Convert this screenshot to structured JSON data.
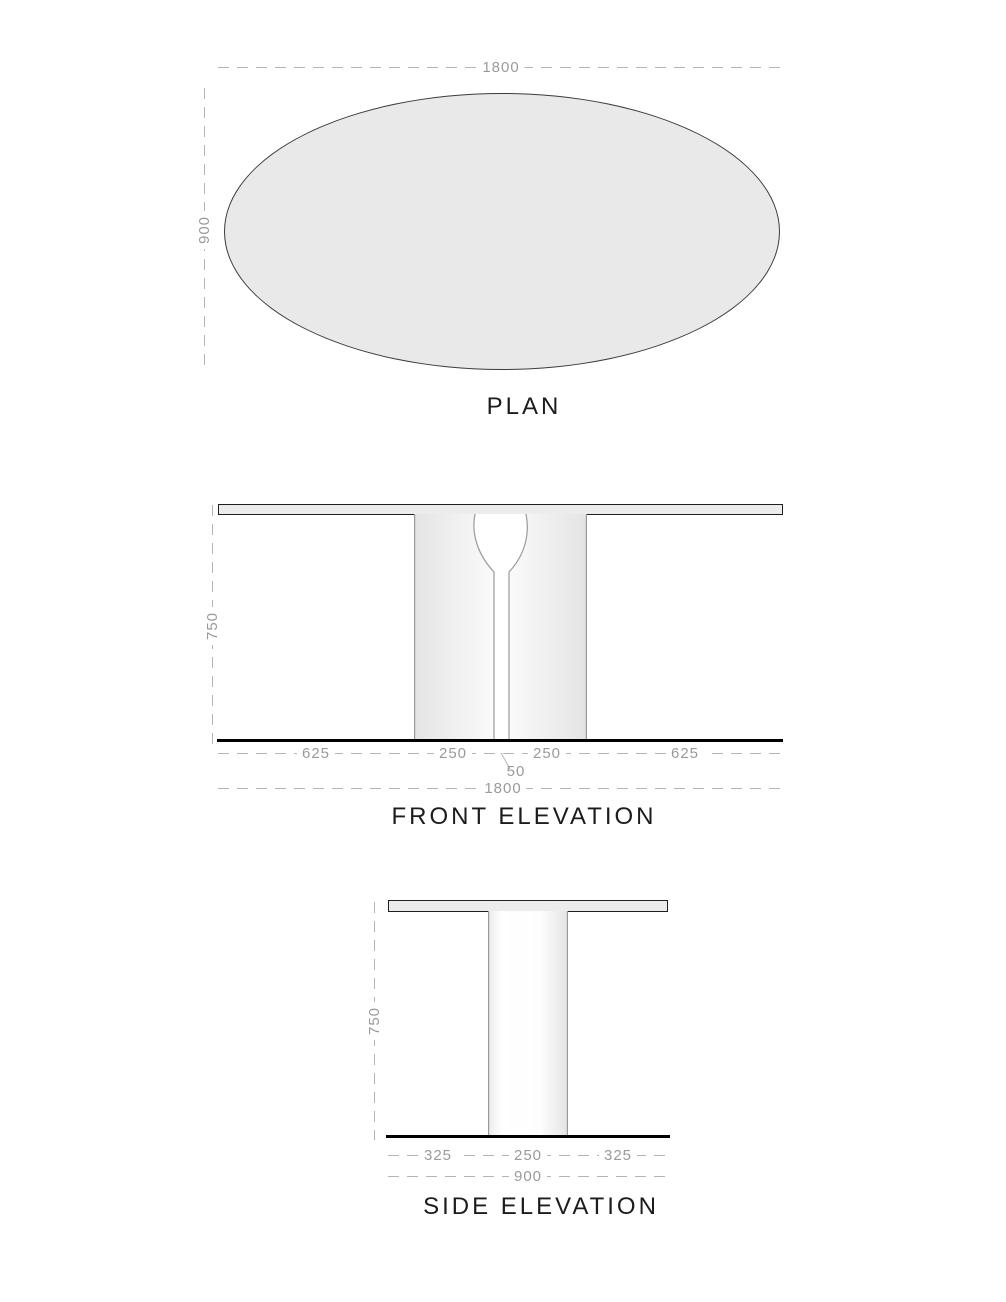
{
  "plan": {
    "title": "PLAN",
    "width_dim": "1800",
    "depth_dim": "900"
  },
  "front": {
    "title": "FRONT ELEVATION",
    "height_dim": "750",
    "segments": [
      "625",
      "250",
      "250",
      "625"
    ],
    "gap_dim": "50",
    "overall_dim": "1800"
  },
  "side": {
    "title": "SIDE ELEVATION",
    "height_dim": "750",
    "segments": [
      "325",
      "250",
      "325"
    ],
    "overall_dim": "900"
  },
  "colors": {
    "fill_light": "#e9e9e9",
    "outline_dark": "#1f1f1f",
    "column_edge": "#9a9a9a",
    "dim_line": "#b4b4b4",
    "dim_text": "#9a9a9a",
    "floor": "#000000"
  }
}
